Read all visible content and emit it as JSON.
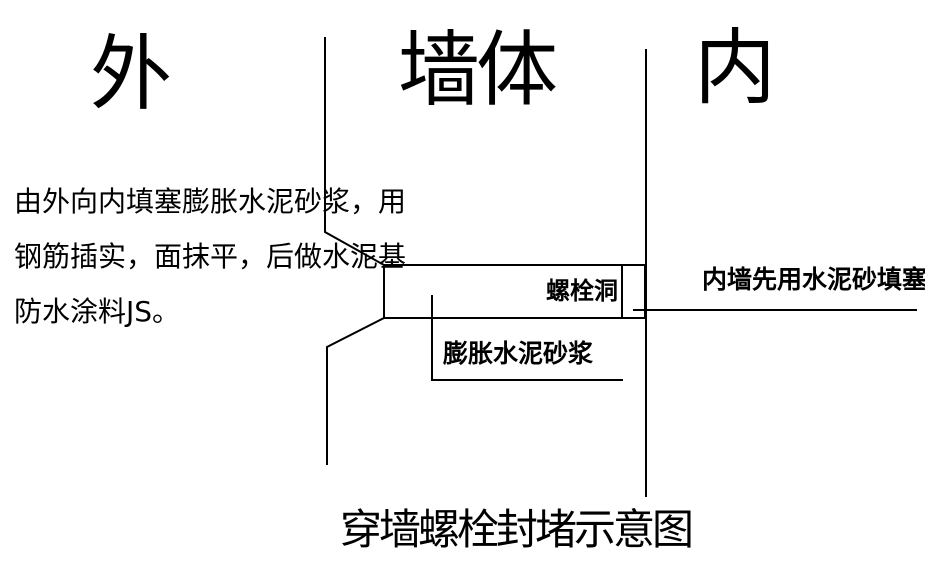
{
  "page": {
    "background_color": "#ffffff",
    "line_color": "#000000",
    "text_color": "#000000"
  },
  "top_labels": {
    "outside": "外",
    "wall": "墙体",
    "inside": "内"
  },
  "left_note": {
    "lines": [
      "由外向内填塞膨胀水泥砂浆，用",
      "钢筋插实，面抹平，后做水泥基",
      "防水涂料JS。"
    ]
  },
  "annotations": {
    "bolt_hole": "螺栓洞",
    "expansion_mortar": "膨胀水泥砂浆",
    "inner_wall": "内墙先用水泥砂填塞"
  },
  "title": "穿墙螺栓封堵示意图"
}
